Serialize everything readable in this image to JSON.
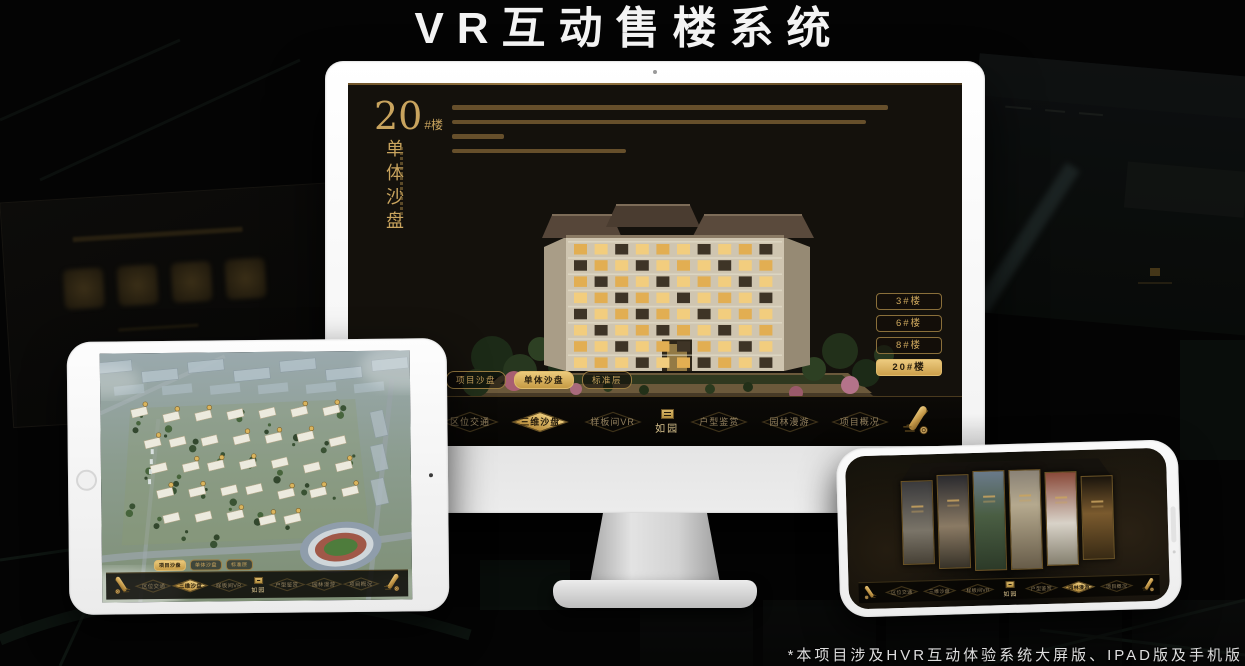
{
  "page": {
    "title": "VR互动售楼系统",
    "footnote": "*本项目涉及HVR互动体验系统大屏版、IPAD版及手机版"
  },
  "colors": {
    "gold": "#c9a45e",
    "gold_bright": "#e3bb6d",
    "nav_text": "#93815f",
    "screen_bg": "#14110c",
    "active_text": "#241b0c"
  },
  "app": {
    "logo_text": "如园",
    "nav_items": [
      {
        "label": "区位交通"
      },
      {
        "label": "三维沙盘"
      },
      {
        "label": "样板间VR"
      },
      {
        "label": "户型鉴赏"
      },
      {
        "label": "园林漫游"
      },
      {
        "label": "项目概况"
      }
    ],
    "subtabs": [
      {
        "label": "项目沙盘"
      },
      {
        "label": "单体沙盘"
      },
      {
        "label": "标准层"
      }
    ]
  },
  "monitor_screen": {
    "section_number": "20",
    "section_unit": "#楼",
    "section_title": "单体沙盘",
    "active_subtab": "单体沙盘",
    "active_nav": "三维沙盘",
    "building_buttons": [
      {
        "label": "3#楼",
        "active": false
      },
      {
        "label": "6#楼",
        "active": false
      },
      {
        "label": "8#楼",
        "active": false
      },
      {
        "label": "20#楼",
        "active": true
      }
    ]
  },
  "tablet_screen": {
    "active_subtab": "项目沙盘",
    "active_nav": "三维沙盘"
  },
  "phone_screen": {
    "active_nav": "园林漫游"
  }
}
